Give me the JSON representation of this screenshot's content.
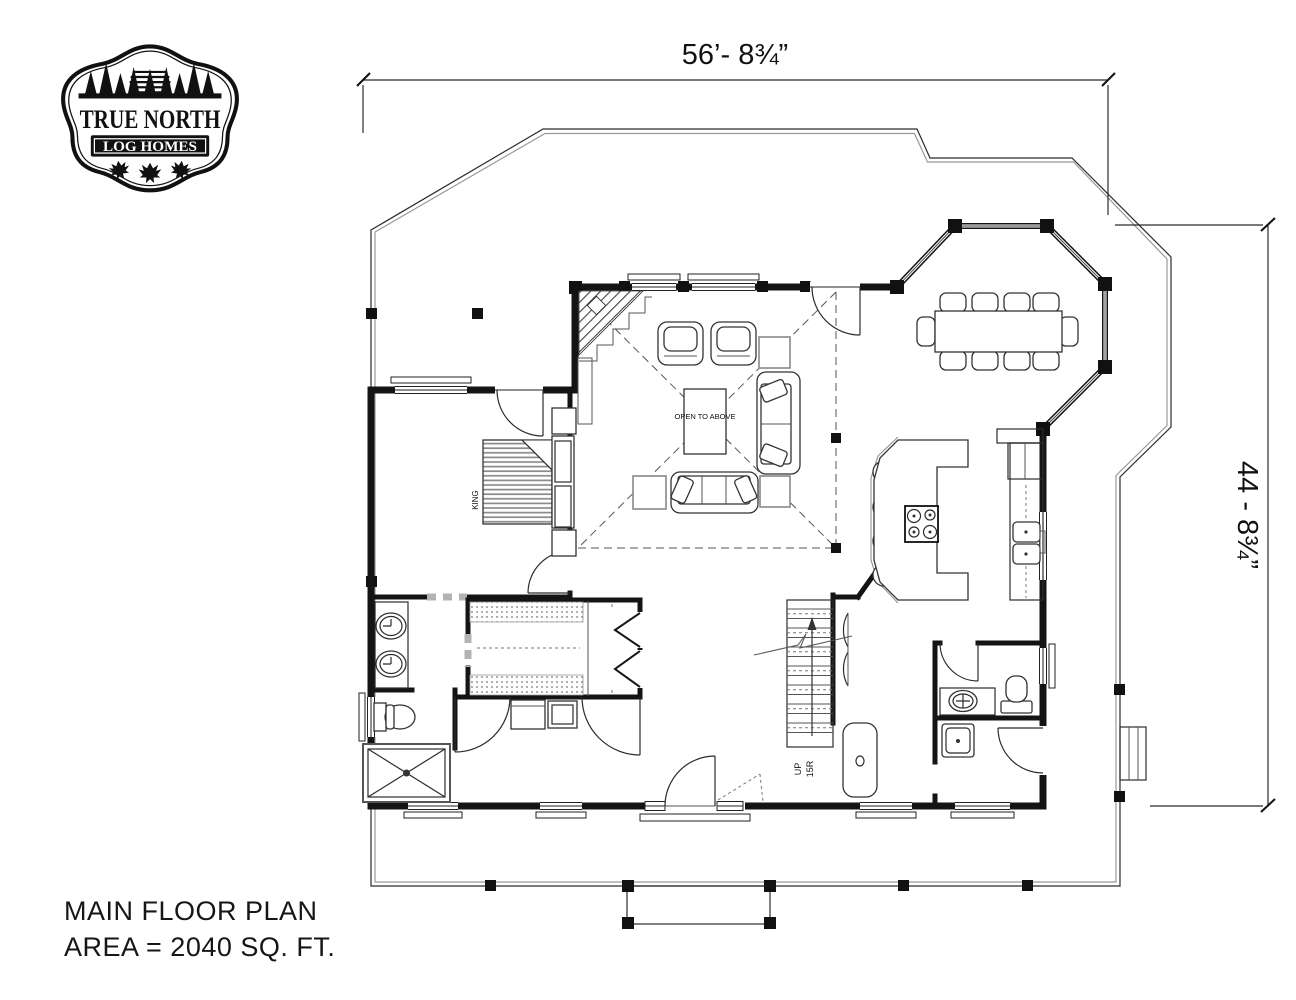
{
  "logo": {
    "title": "TRUE NORTH",
    "subtitle": "LOG HOMES"
  },
  "dimensions": {
    "top": "56’- 8¾”",
    "right": "44 - 8¾”"
  },
  "plan_labels": {
    "open_to_above": "OPEN TO ABOVE",
    "bed": "KING",
    "stairs_direction": "UP",
    "stairs_risers": "15R"
  },
  "title_block": {
    "line1": "MAIN FLOOR PLAN",
    "line2": "AREA = 2040 SQ. FT."
  }
}
